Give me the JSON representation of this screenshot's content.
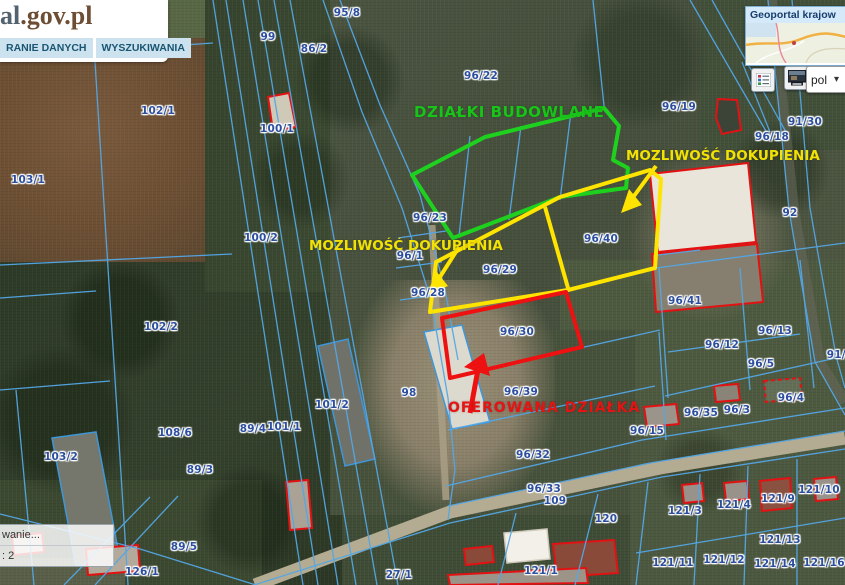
{
  "header": {
    "logo_blue": "al",
    "logo_brown": ".gov.pl",
    "tabs": [
      {
        "label": "RANIE DANYCH"
      },
      {
        "label": "WYSZUKIWANIA"
      }
    ]
  },
  "overview_panel": {
    "title": "Geoportal krajow",
    "language_value": "pol",
    "dropdown_chevron": "▾"
  },
  "status_panel": {
    "rows": [
      {
        "text": "wanie..."
      },
      {
        "text": ": 2"
      }
    ]
  },
  "annotations": {
    "building_plots_label": "DZIAŁKI BUDOWLANE",
    "purchase_option_label_left": "MOZLIWOŚĆ DOKUPIENIA",
    "purchase_option_label_right": "MOZLIWOŚĆ DOKUPIENIA",
    "offered_plot_label": "OFEROWANA DZIAŁKA"
  },
  "colors": {
    "building_plots_outline": "#1fd11f",
    "purchase_option_outline": "#ffe400",
    "offered_plot_outline": "#ee1111",
    "cadastral_line": "#54a7e6",
    "parcel_label_text": "#2c4e9e",
    "building_outline_red": "#e31212"
  },
  "parcels": [
    {
      "id": "95/8",
      "x": 347,
      "y": 13
    },
    {
      "id": "99",
      "x": 268,
      "y": 37
    },
    {
      "id": "86/2",
      "x": 314,
      "y": 49
    },
    {
      "id": "96/22",
      "x": 481,
      "y": 76
    },
    {
      "id": "96/19",
      "x": 679,
      "y": 107
    },
    {
      "id": "91/30",
      "x": 805,
      "y": 122
    },
    {
      "id": "96/18",
      "x": 772,
      "y": 137
    },
    {
      "id": "102/1",
      "x": 158,
      "y": 111
    },
    {
      "id": "100/1",
      "x": 277,
      "y": 129
    },
    {
      "id": "103/1",
      "x": 28,
      "y": 180
    },
    {
      "id": "100/2",
      "x": 261,
      "y": 238
    },
    {
      "id": "96/23",
      "x": 430,
      "y": 218
    },
    {
      "id": "96/1",
      "x": 410,
      "y": 256
    },
    {
      "id": "96/28",
      "x": 428,
      "y": 293
    },
    {
      "id": "96/29",
      "x": 500,
      "y": 270
    },
    {
      "id": "96/40",
      "x": 601,
      "y": 239
    },
    {
      "id": "92",
      "x": 790,
      "y": 213
    },
    {
      "id": "96/30",
      "x": 517,
      "y": 332
    },
    {
      "id": "96/39",
      "x": 521,
      "y": 392
    },
    {
      "id": "96/41",
      "x": 685,
      "y": 301
    },
    {
      "id": "96/13",
      "x": 775,
      "y": 331
    },
    {
      "id": "96/12",
      "x": 722,
      "y": 345
    },
    {
      "id": "96/5",
      "x": 761,
      "y": 364
    },
    {
      "id": "91/3",
      "x": 840,
      "y": 355
    },
    {
      "id": "102/2",
      "x": 161,
      "y": 327
    },
    {
      "id": "108/6",
      "x": 175,
      "y": 433
    },
    {
      "id": "103/2",
      "x": 61,
      "y": 457
    },
    {
      "id": "89/3",
      "x": 200,
      "y": 470
    },
    {
      "id": "89/4",
      "x": 253,
      "y": 429
    },
    {
      "id": "101/1",
      "x": 284,
      "y": 427
    },
    {
      "id": "101/2",
      "x": 332,
      "y": 405
    },
    {
      "id": "98",
      "x": 409,
      "y": 393
    },
    {
      "id": "96/32",
      "x": 533,
      "y": 455
    },
    {
      "id": "96/33",
      "x": 544,
      "y": 489
    },
    {
      "id": "109",
      "x": 555,
      "y": 501
    },
    {
      "id": "120",
      "x": 606,
      "y": 519
    },
    {
      "id": "121/1",
      "x": 541,
      "y": 571
    },
    {
      "id": "96/15",
      "x": 647,
      "y": 431
    },
    {
      "id": "96/35",
      "x": 701,
      "y": 413
    },
    {
      "id": "96/3",
      "x": 737,
      "y": 410
    },
    {
      "id": "96/4",
      "x": 791,
      "y": 398
    },
    {
      "id": "121/3",
      "x": 685,
      "y": 511
    },
    {
      "id": "121/4",
      "x": 734,
      "y": 505
    },
    {
      "id": "121/9",
      "x": 778,
      "y": 499
    },
    {
      "id": "121/10",
      "x": 819,
      "y": 490
    },
    {
      "id": "121/13",
      "x": 780,
      "y": 540
    },
    {
      "id": "121/11",
      "x": 673,
      "y": 563
    },
    {
      "id": "121/12",
      "x": 724,
      "y": 560
    },
    {
      "id": "121/14",
      "x": 775,
      "y": 564
    },
    {
      "id": "121/16",
      "x": 824,
      "y": 563
    },
    {
      "id": "89/5",
      "x": 184,
      "y": 547
    },
    {
      "id": "126/1",
      "x": 142,
      "y": 572
    },
    {
      "id": "27/1",
      "x": 399,
      "y": 575
    }
  ]
}
